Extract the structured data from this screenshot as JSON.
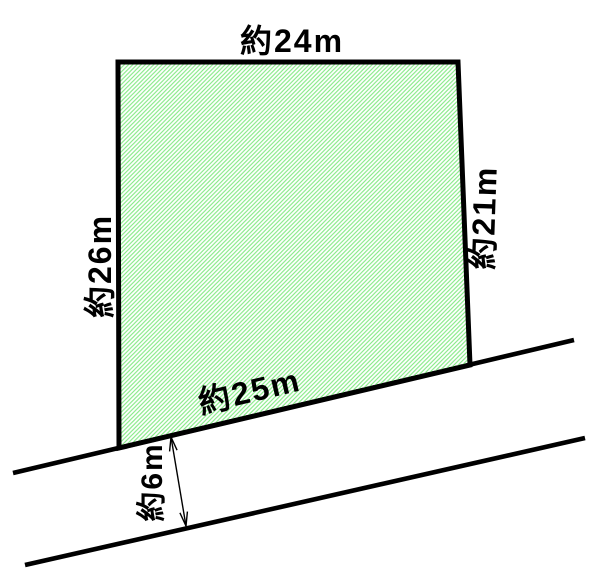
{
  "diagram": {
    "kind": "land-plot-site-diagram",
    "plot": {
      "top_label": "約24m",
      "left_label": "約26m",
      "right_label": "約21m",
      "bottom_label": "約25m",
      "dimensions_m": {
        "top": 24,
        "left": 26,
        "right": 21,
        "bottom": 25
      }
    },
    "road": {
      "width_label": "約6m",
      "width_m": 6
    },
    "icons": {
      "road_width_arrow": "double-headed-dimension-arrow"
    },
    "colors": {
      "outline": "#000000",
      "hatch_line": "#86ea86",
      "background": "#ffffff",
      "text": "#000000"
    }
  }
}
